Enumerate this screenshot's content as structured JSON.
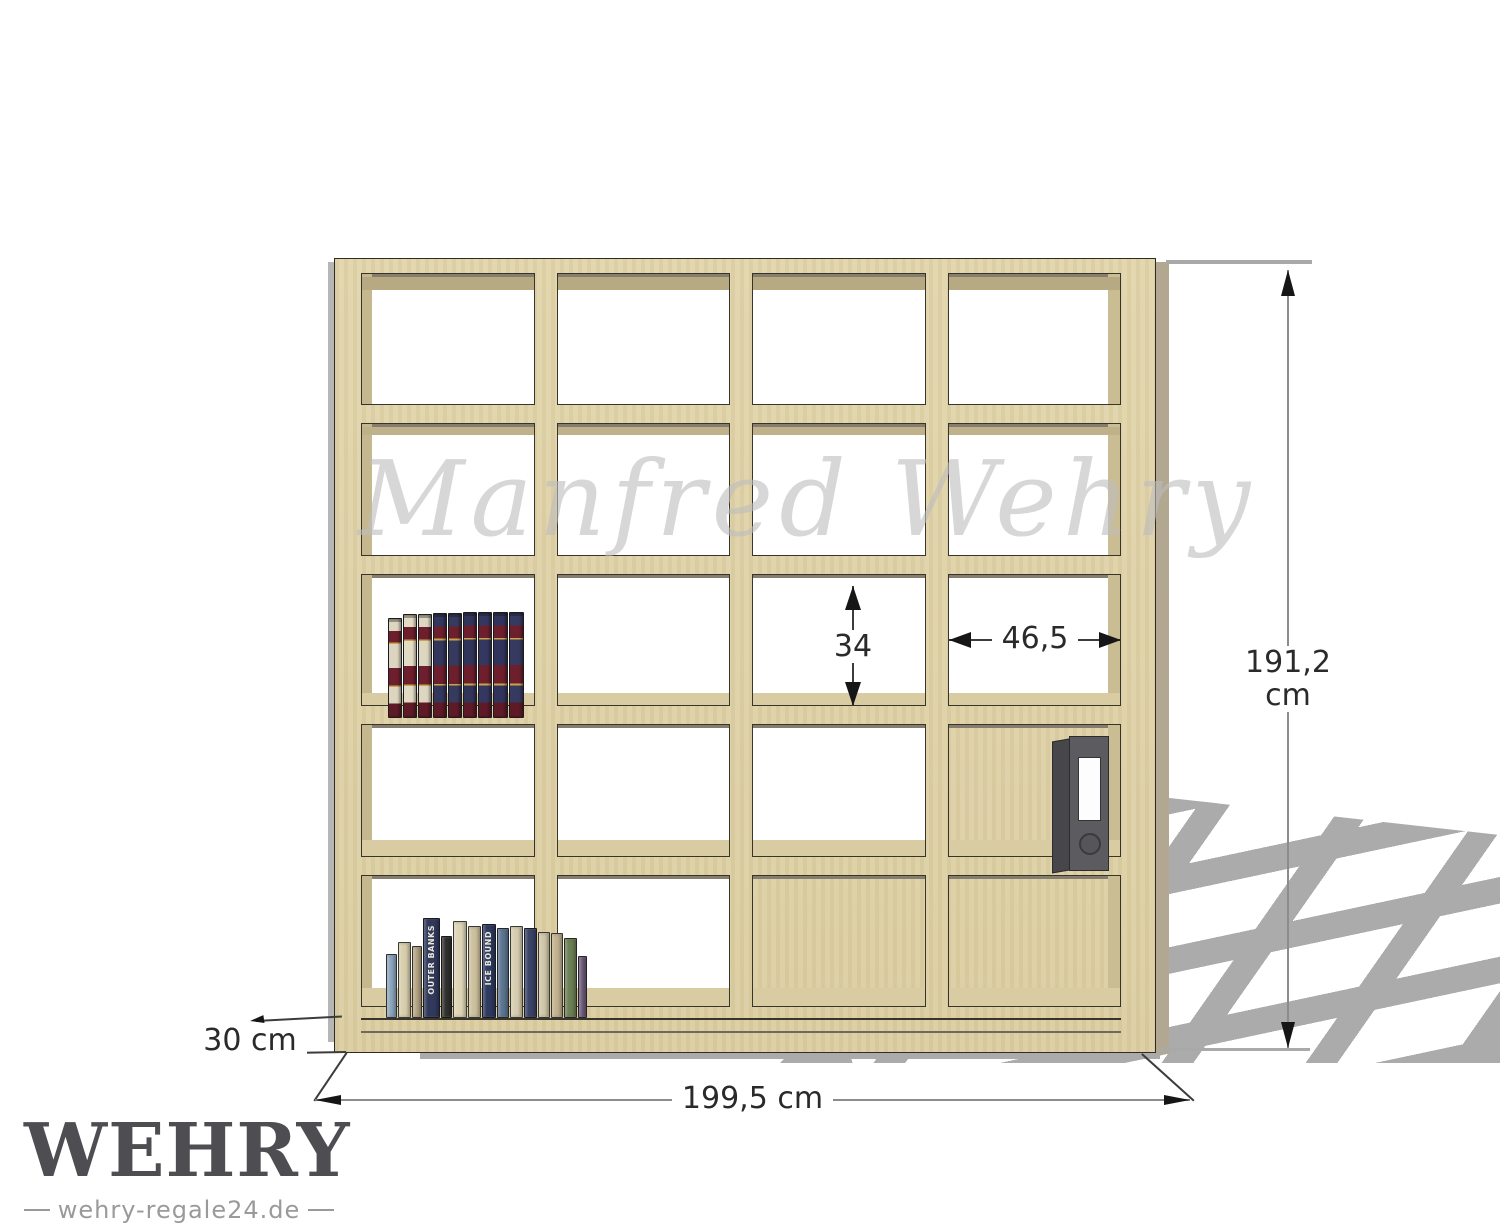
{
  "watermark": {
    "text": "Manfred Wehry",
    "color": "#bdbdbd"
  },
  "logo": {
    "brand": "WEHRY",
    "tagline": "wehry-regale24.de"
  },
  "annotations": {
    "width_label": "199,5 cm",
    "height_label": "191,2 cm",
    "depth_label": "30 cm",
    "cell_width_label": "46,5",
    "cell_height_label": "34"
  },
  "shelf": {
    "rows": 5,
    "columns": 4,
    "wood_color": "#e0d3a8",
    "wood_underside_color": "#b7aa83",
    "under_edge_color": "#857d6e",
    "outline_color": "#2f2b22",
    "side_panel_color": "#b2a891",
    "floor_shadow_color": "#ababab"
  },
  "decor": {
    "encyclopedia_books": [
      {
        "c": "#dcd5bf",
        "h": 98,
        "w": 12
      },
      {
        "c": "#e2dbc4",
        "h": 102,
        "w": 12
      },
      {
        "c": "#ddd6c0",
        "h": 102,
        "w": 12
      },
      {
        "c": "#33375c",
        "h": 103,
        "w": 12
      },
      {
        "c": "#363a5e",
        "h": 103,
        "w": 12
      },
      {
        "c": "#31355a",
        "h": 104,
        "w": 12
      },
      {
        "c": "#343860",
        "h": 104,
        "w": 12
      },
      {
        "c": "#30345c",
        "h": 104,
        "w": 13
      },
      {
        "c": "#363a60",
        "h": 104,
        "w": 13
      }
    ],
    "paperback_books": [
      {
        "c": "#8da6bd",
        "h": 62,
        "w": 9
      },
      {
        "c": "#d8cfae",
        "h": 74,
        "w": 11
      },
      {
        "c": "#b5a584",
        "h": 70,
        "w": 8
      },
      {
        "c": "#31395c",
        "h": 98,
        "w": 15,
        "title": "OUTER BANKS"
      },
      {
        "c": "#30302e",
        "h": 80,
        "w": 9
      },
      {
        "c": "#ddd4b6",
        "h": 95,
        "w": 12
      },
      {
        "c": "#cdc19d",
        "h": 90,
        "w": 11
      },
      {
        "c": "#2e3a60",
        "h": 92,
        "w": 12,
        "title": "ICE BOUND"
      },
      {
        "c": "#5d7590",
        "h": 88,
        "w": 10
      },
      {
        "c": "#d6cdb0",
        "h": 90,
        "w": 11
      },
      {
        "c": "#3a4266",
        "h": 88,
        "w": 11
      },
      {
        "c": "#d0c7a8",
        "h": 84,
        "w": 10
      },
      {
        "c": "#c2b291",
        "h": 83,
        "w": 10
      },
      {
        "c": "#6d7f54",
        "h": 78,
        "w": 11
      },
      {
        "c": "#6e5c7a",
        "h": 60,
        "w": 7
      }
    ],
    "binder": {
      "body_color": "#5b5b60",
      "cover_color": "#46464b",
      "label_color": "#fdfdfd"
    }
  }
}
